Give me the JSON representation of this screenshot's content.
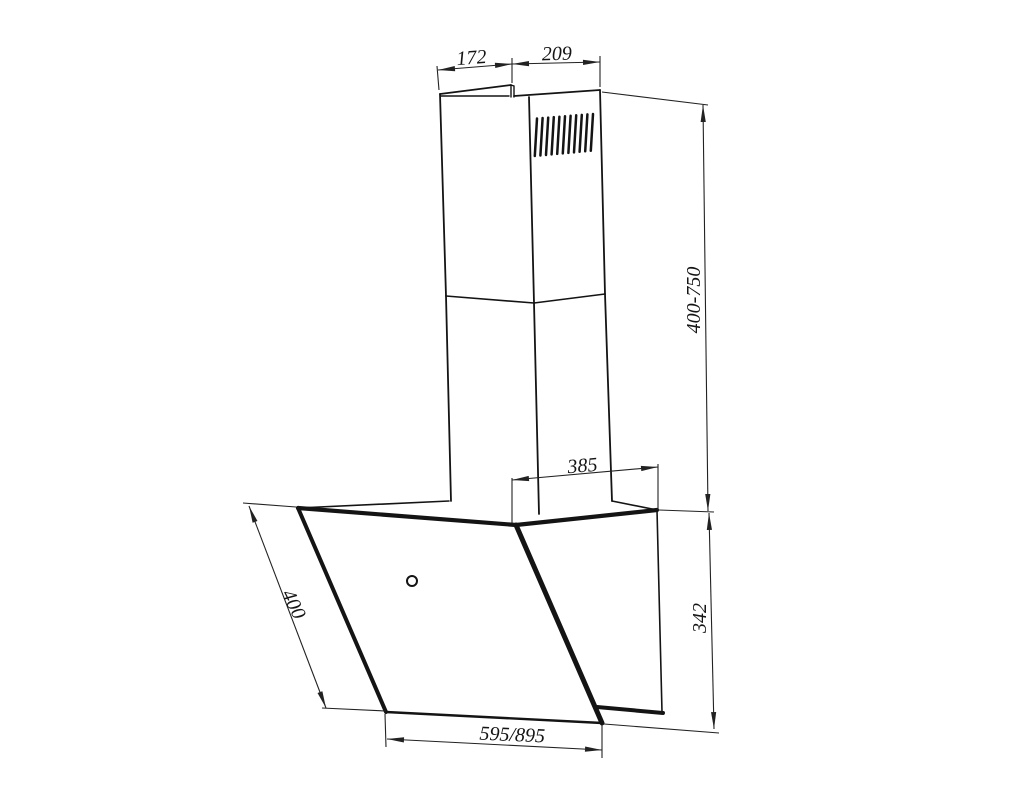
{
  "diagram": {
    "dimensions": {
      "chimney_top_left_width": "172",
      "chimney_top_right_width": "209",
      "chimney_height_range": "400-750",
      "top_depth": "385",
      "body_height": "342",
      "glass_panel_length": "400",
      "body_width": "595/895"
    }
  }
}
